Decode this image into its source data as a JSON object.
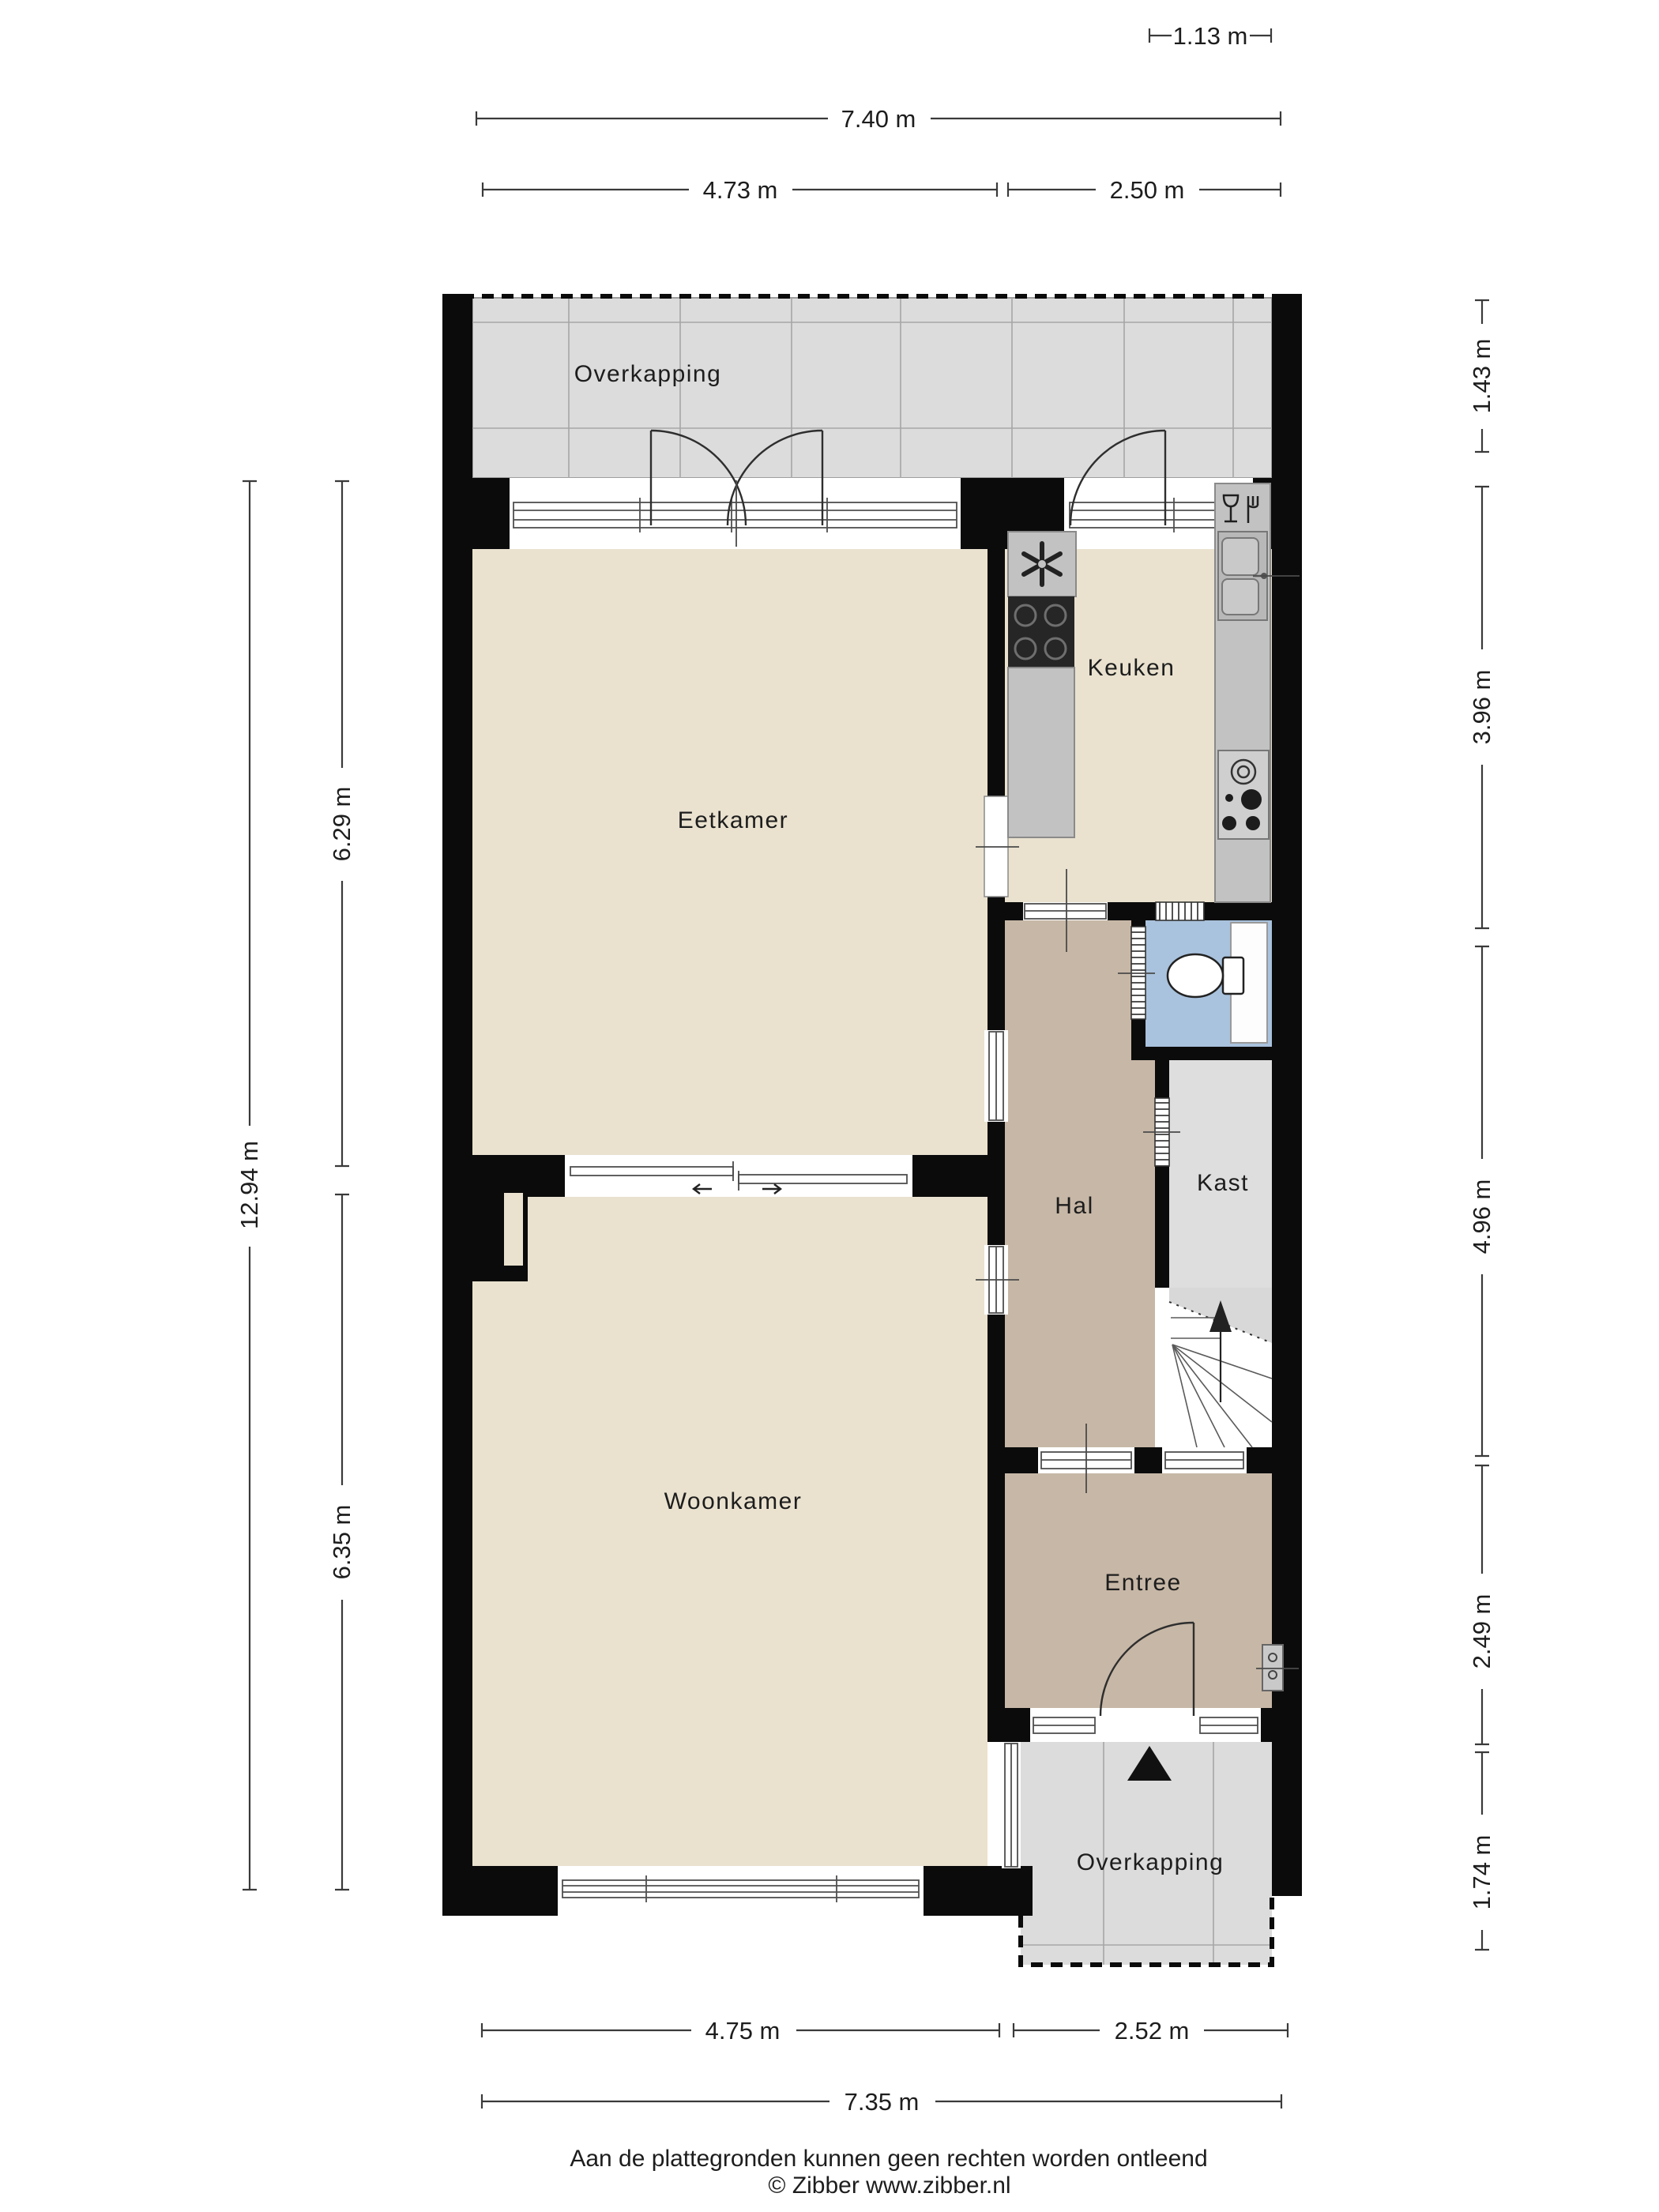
{
  "rooms": {
    "overkapping_top": "Overkapping",
    "eetkamer": "Eetkamer",
    "keuken": "Keuken",
    "hal": "Hal",
    "kast": "Kast",
    "woonkamer": "Woonkamer",
    "entree": "Entree",
    "overkapping_bottom": "Overkapping"
  },
  "dimensions": {
    "top_small": "1.13 m",
    "top_total": "7.40 m",
    "top_left": "4.73 m",
    "top_right": "2.50 m",
    "left_total": "12.94 m",
    "left_upper": "6.29 m",
    "left_lower": "6.35 m",
    "right": [
      "1.43 m",
      "3.96 m",
      "4.96 m",
      "2.49 m",
      "1.74 m"
    ],
    "bottom_left": "4.75 m",
    "bottom_right": "2.52 m",
    "bottom_total": "7.35 m"
  },
  "footer": {
    "disclaimer": "Aan de plattegronden kunnen geen rechten worden ontleend",
    "copyright": "© Zibber www.zibber.nl"
  },
  "icons": {
    "north_arrow": "▲",
    "stairs_up_arrow": "↑",
    "toilet": "toilet-top-view",
    "sink": "double-sink",
    "gas_hob": "4-burner-hob",
    "cooktop": "4-zone-cooktop",
    "extractor_fan": "fan-pinwheel",
    "dishwasher": "glass-and-fork"
  },
  "colors": {
    "wall": "#0b0b0b",
    "floor_living": "#eae2cf",
    "floor_hall": "#c7b7a6",
    "floor_closet": "#dedede",
    "floor_toilet": "#a9c2dd",
    "canopy": "#dcdcdc",
    "counter": "#c2c2c2",
    "cooktop": "#262626",
    "dimension_text": "#222222"
  }
}
